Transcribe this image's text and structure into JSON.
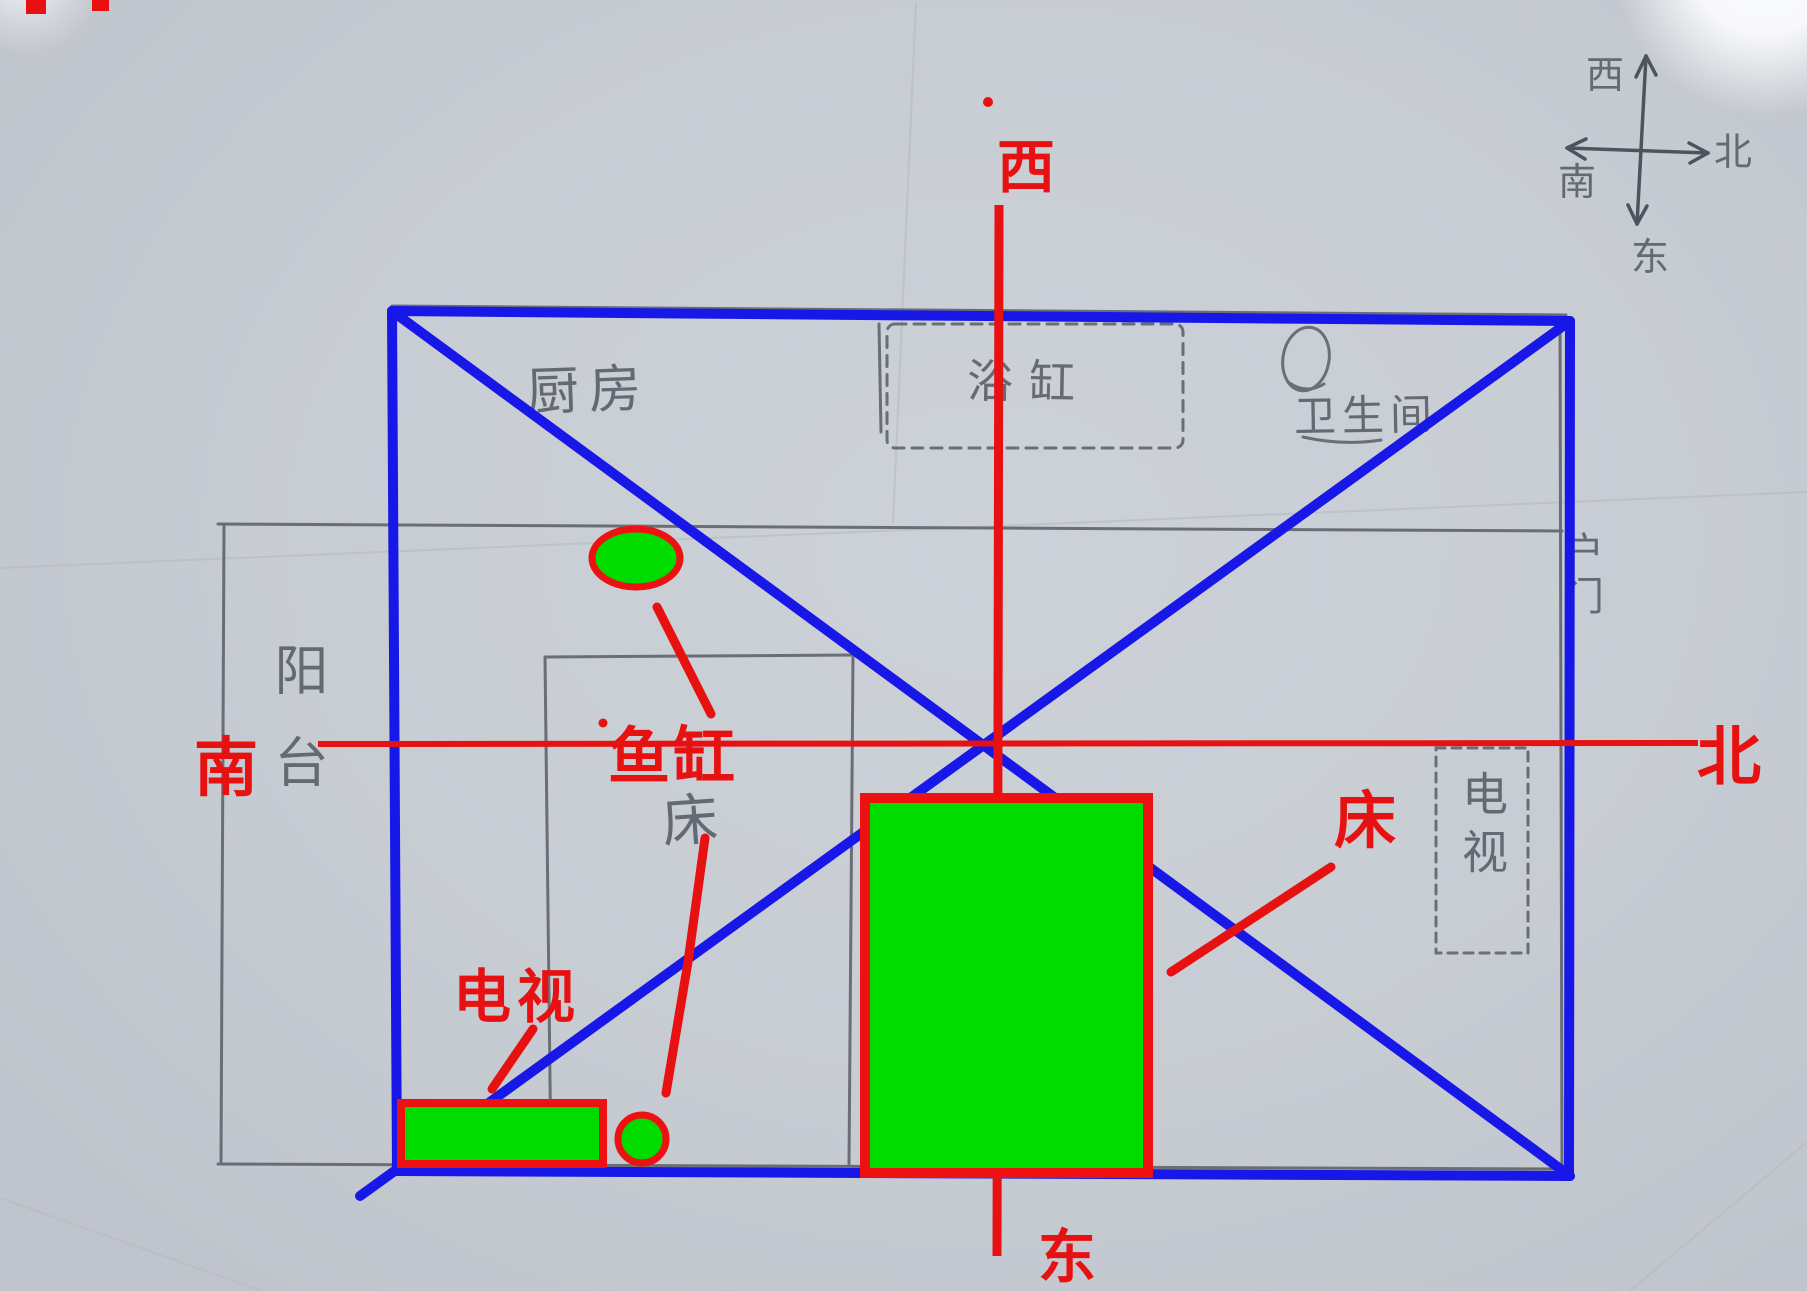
{
  "photo": {
    "description": "Hand-drawn apartment floor plan on gray paper with digital direction cross and furniture annotations"
  },
  "colors": {
    "paper": "#c8ccd3",
    "pencil": "#575d66",
    "blue": "#1717e8",
    "red": "#e81111",
    "green": "#00dc00"
  },
  "red_axis": {
    "west": "西",
    "east": "东",
    "south": "南",
    "north": "北"
  },
  "pencil_compass": {
    "west": "西",
    "east": "东",
    "south": "南",
    "north": "北"
  },
  "pencil_rooms": {
    "kitchen": "厨房",
    "bathtub": "浴缸",
    "bathroom": "卫生间",
    "balcony": "阳台",
    "bed": "床",
    "tv": "电视",
    "door": "户门"
  },
  "red_furniture": {
    "fish_tank": "鱼缸",
    "tv": "电视",
    "bed": "床"
  }
}
